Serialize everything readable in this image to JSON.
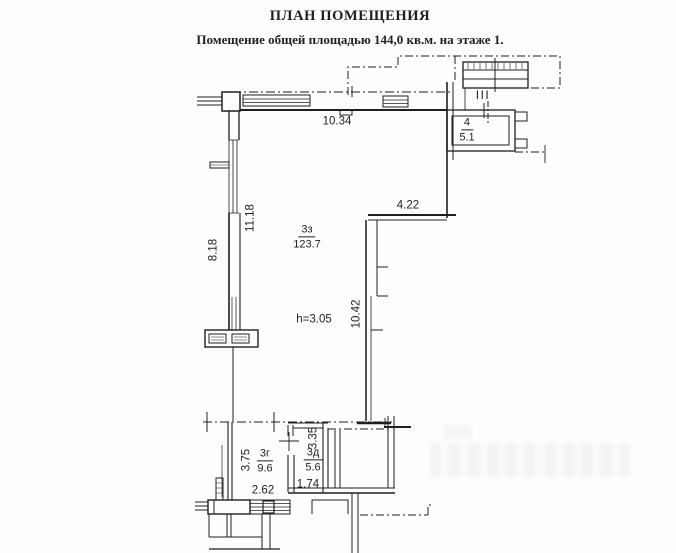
{
  "header": {
    "title": "ПЛАН ПОМЕЩЕНИЯ",
    "subtitle": "Помещение общей площадью 144,0 кв.м. на этаже 1."
  },
  "plan": {
    "section_mark": "III",
    "height_note": "h=3.05",
    "rooms": [
      {
        "number": "3з",
        "area": "123.7"
      },
      {
        "number": "4",
        "area": "5.1"
      },
      {
        "number": "3г",
        "area": "9.6"
      },
      {
        "number": "3д",
        "area": "5.6"
      }
    ],
    "dimensions": [
      {
        "id": "top-wall",
        "value": "10.34"
      },
      {
        "id": "left-outer",
        "value": "8.18"
      },
      {
        "id": "left-inner",
        "value": "11.18"
      },
      {
        "id": "step-wall",
        "value": "4.22"
      },
      {
        "id": "right-inner",
        "value": "10.42"
      },
      {
        "id": "room-3g-depth",
        "value": "3.75"
      },
      {
        "id": "room-3g-width",
        "value": "2.62"
      },
      {
        "id": "room-3d-depth",
        "value": "3.35"
      },
      {
        "id": "room-3d-width",
        "value": "1.74"
      }
    ],
    "colors": {
      "ink": "#1f1f1f",
      "paper": "#fdfdfd"
    }
  }
}
